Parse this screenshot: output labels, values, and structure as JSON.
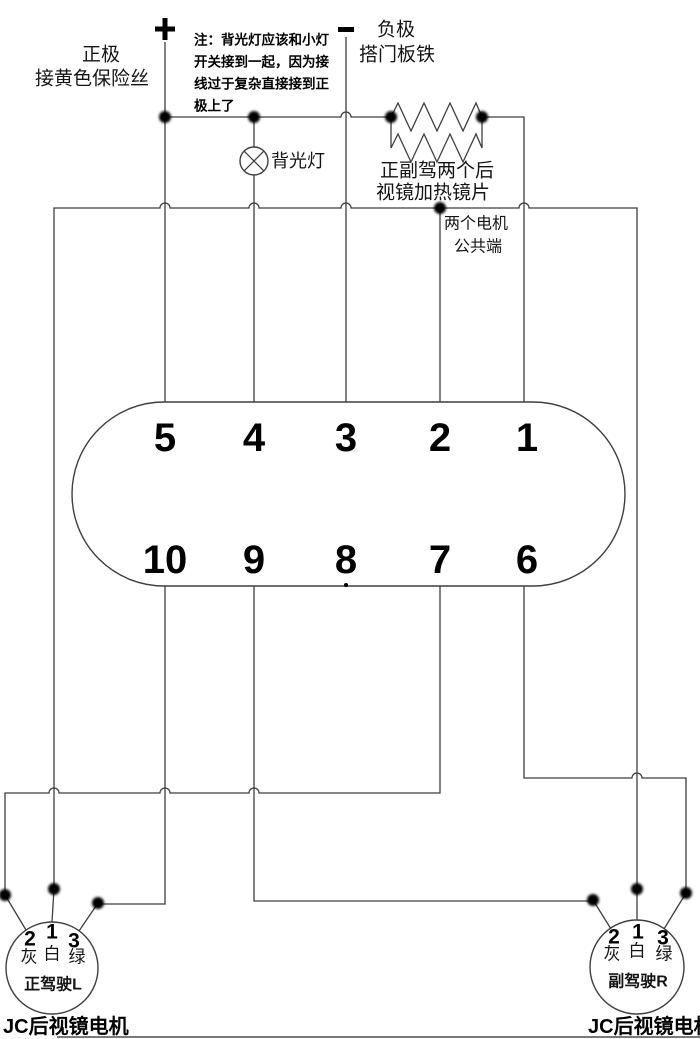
{
  "power": {
    "positive": {
      "symbol": "+",
      "label_line1": "正极",
      "label_line2": "接黄色保险丝"
    },
    "negative": {
      "symbol": "-",
      "label_line1": "负极",
      "label_line2": "搭门板铁"
    }
  },
  "note": {
    "line1": "注：背光灯应该和小灯",
    "line2": "开关接到一起，因为接",
    "line3": "线过于复杂直接接到正",
    "line4": "极上了"
  },
  "backlight": {
    "label": "背光灯"
  },
  "heater": {
    "label_line1": "正副驾两个后",
    "label_line2": "视镜加热镜片"
  },
  "motor_common": {
    "label_line1": "两个电机",
    "label_line2": "公共端"
  },
  "connector": {
    "top_pins": [
      "5",
      "4",
      "3",
      "2",
      "1"
    ],
    "bottom_pins": [
      "10",
      "9",
      "8",
      "7",
      "6"
    ]
  },
  "motors": {
    "left": {
      "terminal_numbers": [
        "2",
        "1",
        "3"
      ],
      "wire_colors": [
        "灰",
        "白",
        "绿"
      ],
      "position_label": "正驾驶L",
      "caption": "JC后视镜电机"
    },
    "right": {
      "terminal_numbers": [
        "2",
        "1",
        "3"
      ],
      "wire_colors": [
        "灰",
        "白",
        "绿"
      ],
      "position_label": "副驾驶R",
      "caption": "JC后视镜电机"
    }
  },
  "colors": {
    "wire": "#3f3f3f",
    "text": "#141414",
    "background": "#ffffff"
  }
}
